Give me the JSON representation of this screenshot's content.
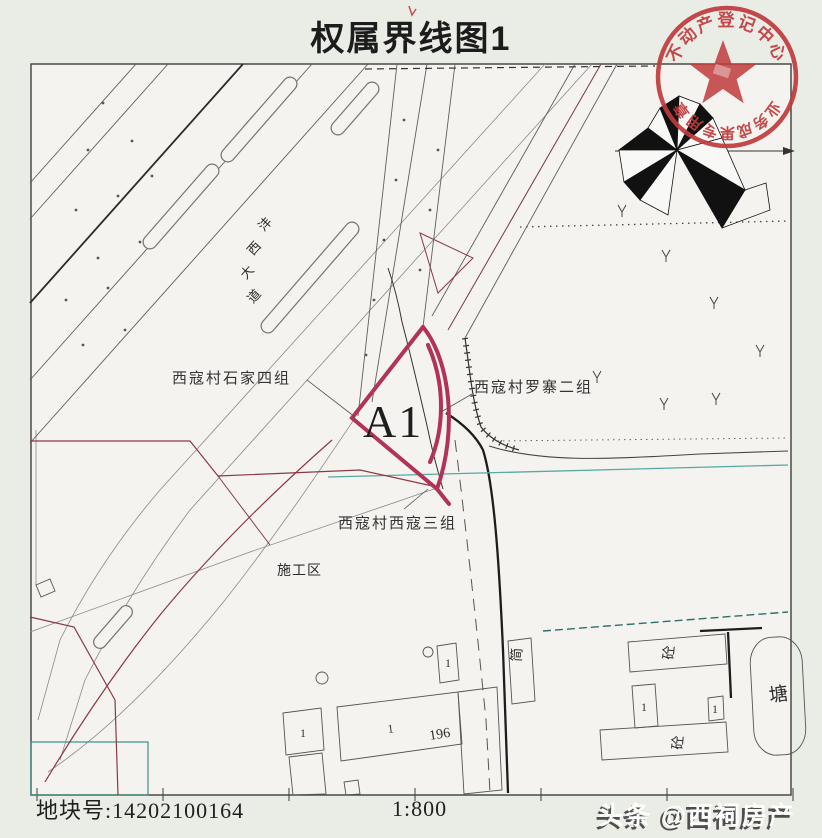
{
  "document": {
    "title": "权属界线图1",
    "plot_number": "地块号:14202100164",
    "scale": "1:800",
    "watermark": "头条 @西祠房产"
  },
  "map": {
    "parcel_code": "A1",
    "road_name": {
      "c0": "沣",
      "c1": "西",
      "c2": "大",
      "c3": "道"
    },
    "labels": {
      "west_group": "西寇村石家四组",
      "east_group": "西寇村罗寨二组",
      "south_group": "西寇村西寇三组",
      "construction_area": "施工区",
      "pond": "塘",
      "shed": "简",
      "building_number": "196",
      "floor_count": "1",
      "structure_concrete": "砼"
    },
    "colors": {
      "parcel_boundary": "#b13357",
      "ownership_line": "#8a3a44",
      "pipeline": "#56aaa2",
      "stamp_red": "#c03b3c",
      "map_lines": "#444444"
    }
  },
  "stamp": {
    "arc_top": "不动产登记中心",
    "arc_bottom": "业务成果专用章"
  },
  "compass": {
    "type": "wind-rose-north-arrow"
  }
}
